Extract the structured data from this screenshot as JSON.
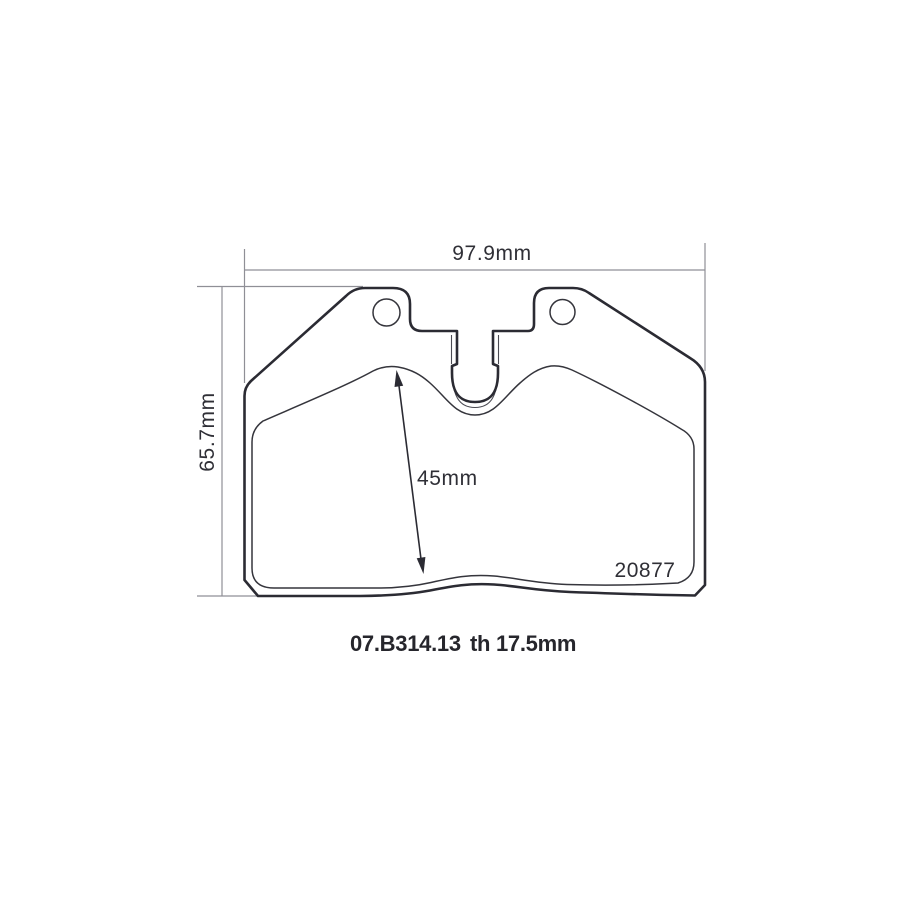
{
  "drawing": {
    "dimensions": {
      "overall_width": "97.9mm",
      "overall_height": "65.7mm",
      "friction_height": "45mm"
    },
    "labels": {
      "backplate_number": "20877",
      "part_code": "07.B314.13",
      "thickness": "th 17.5mm"
    },
    "colors": {
      "outline": "#2b2b33",
      "dimension_line": "#8f8f96",
      "text": "#2f2f36",
      "background": "#ffffff"
    }
  }
}
